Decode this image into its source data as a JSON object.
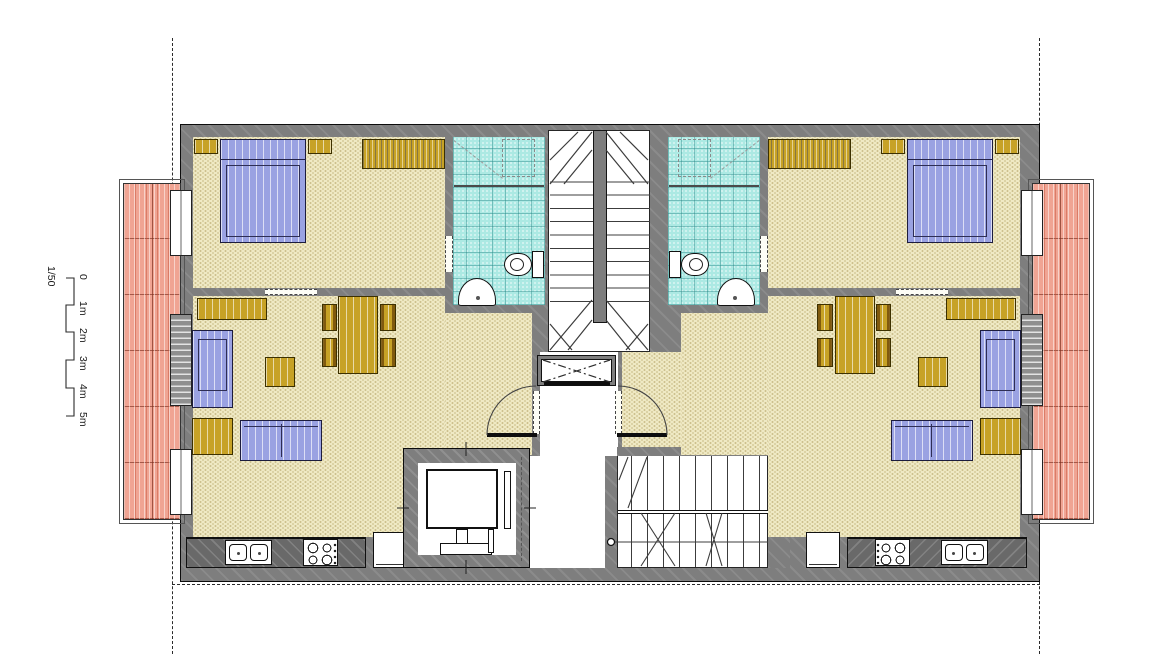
{
  "scale_bar": {
    "ratio_label": "1/50",
    "tick_labels": [
      "0",
      "1m",
      "2m",
      "3m",
      "4m",
      "5m"
    ]
  },
  "palette": {
    "wall": "#7e7e7e",
    "floor": "#efe9c4",
    "bathroom_tile": "#ace9e3",
    "balcony_tile": "#f0a493",
    "fabric_blue": "#9aa2e2",
    "wood_gold": "#c7a226",
    "counter_top": "#696969"
  }
}
